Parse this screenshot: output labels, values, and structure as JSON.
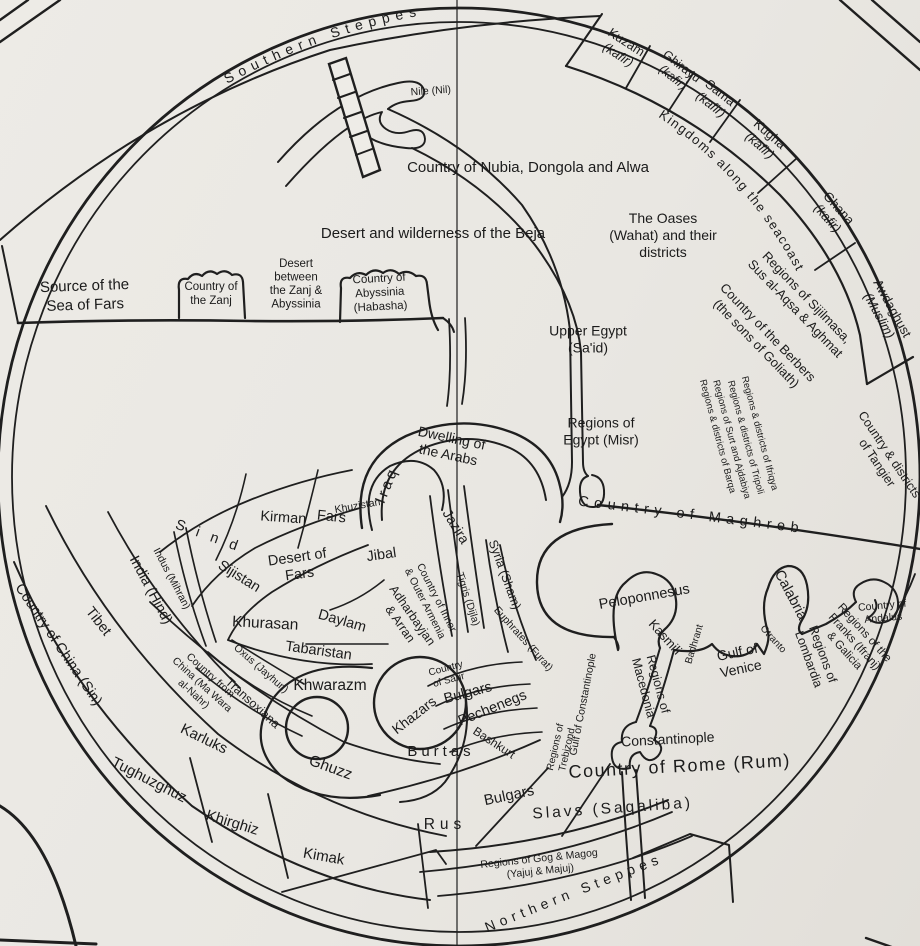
{
  "map": {
    "description": "Circular medieval world map (south at top) with translated region names",
    "colors": {
      "paper": "#eae8e3",
      "ink": "#1f1f1f",
      "fold_line": "#4a4a4a"
    },
    "arc_labels": [
      {
        "id": "southern-steppes",
        "text": "Southern Steppes",
        "path": "pathSouth",
        "size": 14,
        "ls": 6,
        "offset": "6%"
      },
      {
        "id": "kingdoms-seacoast",
        "text": "Kingdoms along the seacoast",
        "path": "pathSeacoast",
        "size": 13,
        "ls": 1.5,
        "offset": "2%"
      },
      {
        "id": "country-of-maghreb",
        "text": "Country of Maghreb",
        "path": "pathMaghreb",
        "size": 14.5,
        "ls": 5.5,
        "offset": "8%"
      },
      {
        "id": "northern-steppes",
        "text": "Northern Steppes",
        "path": "pathNorth",
        "size": 14,
        "ls": 5,
        "offset": "4%"
      }
    ],
    "labels": [
      {
        "id": "nile",
        "lines": [
          "Nile (Nil)"
        ],
        "x": 431,
        "y": 94,
        "rot": -4,
        "size": 10.5
      },
      {
        "id": "nubia-dongola-alwa",
        "lines": [
          "Country of Nubia, Dongola and Alwa"
        ],
        "x": 528,
        "y": 172,
        "rot": 0,
        "size": 15
      },
      {
        "id": "beja-desert",
        "lines": [
          "Desert and wilderness of the Beja"
        ],
        "x": 433,
        "y": 238,
        "rot": 0,
        "size": 15
      },
      {
        "id": "oases",
        "lines": [
          "The Oases",
          "(Wahat) and their",
          "districts"
        ],
        "x": 663,
        "y": 240,
        "rot": 0,
        "size": 14,
        "lh": 17
      },
      {
        "id": "source-sea-of-fars",
        "lines": [
          "Source of the",
          "Sea of Fars"
        ],
        "x": 85,
        "y": 300,
        "rot": -2,
        "size": 15,
        "lh": 19
      },
      {
        "id": "country-of-zanj",
        "lines": [
          "Country of",
          "the Zanj"
        ],
        "x": 211,
        "y": 297,
        "rot": 0,
        "size": 11.5,
        "lh": 14
      },
      {
        "id": "desert-zanj-abyssinia",
        "lines": [
          "Desert",
          "between",
          "the Zanj &",
          "Abyssinia"
        ],
        "x": 296,
        "y": 287,
        "rot": 0,
        "size": 11.5,
        "lh": 13.5
      },
      {
        "id": "abyssinia",
        "lines": [
          "Country of",
          "Abyssinia",
          "(Habasha)"
        ],
        "x": 380,
        "y": 296,
        "rot": -3,
        "size": 11.5,
        "lh": 14
      },
      {
        "id": "kuzam",
        "lines": [
          "Kuzam",
          "(kafir)"
        ],
        "x": 620,
        "y": 52,
        "rot": 33,
        "size": 13,
        "lh": 15,
        "i2": true
      },
      {
        "id": "ghirayu",
        "lines": [
          "Ghirayu",
          "(kafir)"
        ],
        "x": 675,
        "y": 75,
        "rot": 38,
        "size": 12.5,
        "lh": 14,
        "i2": true
      },
      {
        "id": "sama",
        "lines": [
          "Sama",
          "(kafir)"
        ],
        "x": 713,
        "y": 102,
        "rot": 38,
        "size": 13,
        "lh": 15,
        "i2": true
      },
      {
        "id": "kugha",
        "lines": [
          "Kugha",
          "(kafir)"
        ],
        "x": 762,
        "y": 143,
        "rot": 41,
        "size": 13,
        "lh": 15,
        "i2": true
      },
      {
        "id": "ghana",
        "lines": [
          "Ghana",
          "(kafir)"
        ],
        "x": 830,
        "y": 216,
        "rot": 48,
        "size": 13,
        "lh": 15,
        "i2": true
      },
      {
        "id": "awdaghust",
        "lines": [
          "Awdaghust",
          "(Muslim)"
        ],
        "x": 882,
        "y": 314,
        "rot": 61,
        "size": 13,
        "lh": 15,
        "i2": true
      },
      {
        "id": "sijilmasa",
        "lines": [
          "Regions of Sijilmasa,",
          "Sus al-Aqsa & Aghmat"
        ],
        "x": 798,
        "y": 306,
        "rot": 46,
        "size": 13,
        "lh": 16
      },
      {
        "id": "berbers",
        "lines": [
          "Country of the Berbers",
          "(the sons of Goliath)"
        ],
        "x": 759,
        "y": 341,
        "rot": 46,
        "size": 13,
        "lh": 16
      },
      {
        "id": "ifriqya",
        "lines": [
          "Regions & districts of Ifriqya"
        ],
        "x": 757,
        "y": 434,
        "rot": 75,
        "size": 9.5
      },
      {
        "id": "tripoli",
        "lines": [
          "Regions & districts of Tripoli"
        ],
        "x": 743,
        "y": 438,
        "rot": 75,
        "size": 9.5
      },
      {
        "id": "surt-ajdabiya",
        "lines": [
          "Regions of Surt and Ajdabiya"
        ],
        "x": 729,
        "y": 440,
        "rot": 75,
        "size": 9.5
      },
      {
        "id": "barqa",
        "lines": [
          "Regions & districts of Barqa"
        ],
        "x": 715,
        "y": 437,
        "rot": 75,
        "size": 9.5
      },
      {
        "id": "tangier",
        "lines": [
          "Country & districts",
          "of Tangier"
        ],
        "x": 880,
        "y": 461,
        "rot": 56,
        "size": 12.5,
        "lh": 15
      },
      {
        "id": "upper-egypt",
        "lines": [
          "Upper Egypt",
          "(Sa'id)"
        ],
        "x": 588,
        "y": 344,
        "rot": 0,
        "size": 14,
        "lh": 17
      },
      {
        "id": "regions-of-egypt",
        "lines": [
          "Regions of",
          "Egypt (Misr)"
        ],
        "x": 601,
        "y": 436,
        "rot": 0,
        "size": 14,
        "lh": 17
      },
      {
        "id": "dwelling-arabs",
        "lines": [
          "Dwelling of",
          "the Arabs"
        ],
        "x": 449,
        "y": 451,
        "rot": 12,
        "size": 14,
        "lh": 17
      },
      {
        "id": "iraq",
        "lines": [
          "Iraq"
        ],
        "x": 391,
        "y": 487,
        "rot": -68,
        "size": 15,
        "ls": 3
      },
      {
        "id": "khuzistan",
        "lines": [
          "Khuzistan"
        ],
        "x": 358,
        "y": 509,
        "rot": -10,
        "size": 10.5
      },
      {
        "id": "fars",
        "lines": [
          "Fars"
        ],
        "x": 331,
        "y": 521,
        "rot": 6,
        "size": 14.5
      },
      {
        "id": "kirman",
        "lines": [
          "Kirman"
        ],
        "x": 283,
        "y": 522,
        "rot": 4,
        "size": 14.5
      },
      {
        "id": "sind",
        "lines": [
          "S i n d"
        ],
        "x": 207,
        "y": 540,
        "rot": 20,
        "size": 14.5,
        "ls": 4
      },
      {
        "id": "sijistan",
        "lines": [
          "Sijistan"
        ],
        "x": 237,
        "y": 580,
        "rot": 32,
        "size": 14.5
      },
      {
        "id": "desert-of-fars",
        "lines": [
          "Desert of",
          "Fars"
        ],
        "x": 299,
        "y": 570,
        "rot": -8,
        "size": 14.5,
        "lh": 17
      },
      {
        "id": "jibal",
        "lines": [
          "Jibal"
        ],
        "x": 382,
        "y": 559,
        "rot": -8,
        "size": 14.5
      },
      {
        "id": "india",
        "lines": [
          "India (Hind)"
        ],
        "x": 147,
        "y": 592,
        "rot": 62,
        "size": 14.5
      },
      {
        "id": "indus",
        "lines": [
          "Indus (Mihran)"
        ],
        "x": 169,
        "y": 580,
        "rot": 62,
        "size": 10.5
      },
      {
        "id": "tibet",
        "lines": [
          "Tibet"
        ],
        "x": 95,
        "y": 624,
        "rot": 52,
        "size": 14.5
      },
      {
        "id": "china",
        "lines": [
          "Country of China (Sin)"
        ],
        "x": 55,
        "y": 647,
        "rot": 56,
        "size": 14.5
      },
      {
        "id": "khurasan",
        "lines": [
          "Khurasan"
        ],
        "x": 265,
        "y": 628,
        "rot": 3,
        "size": 15.5
      },
      {
        "id": "daylam",
        "lines": [
          "Daylam"
        ],
        "x": 341,
        "y": 625,
        "rot": 16,
        "size": 14.5
      },
      {
        "id": "tabaristan",
        "lines": [
          "Tabaristan"
        ],
        "x": 318,
        "y": 655,
        "rot": 8,
        "size": 14.5
      },
      {
        "id": "armenia",
        "lines": [
          "Country of Inner",
          "& Outer Armenia"
        ],
        "x": 428,
        "y": 602,
        "rot": 63,
        "size": 10.5,
        "lh": 13
      },
      {
        "id": "adharbayjan",
        "lines": [
          "Adharbayjan",
          "& Arran"
        ],
        "x": 403,
        "y": 622,
        "rot": 55,
        "size": 12.5,
        "lh": 15
      },
      {
        "id": "jazira",
        "lines": [
          "Jazira"
        ],
        "x": 452,
        "y": 529,
        "rot": 58,
        "size": 14
      },
      {
        "id": "tigris",
        "lines": [
          "Tigris (Dijla)"
        ],
        "x": 465,
        "y": 600,
        "rot": 72,
        "size": 10.5
      },
      {
        "id": "syria",
        "lines": [
          "Syria (Sham)"
        ],
        "x": 501,
        "y": 576,
        "rot": 70,
        "size": 12.5
      },
      {
        "id": "euphrates",
        "lines": [
          "Euphrates (Furat)"
        ],
        "x": 521,
        "y": 641,
        "rot": 48,
        "size": 10.5
      },
      {
        "id": "oxus",
        "lines": [
          "Oxus (Jayhun)"
        ],
        "x": 259,
        "y": 671,
        "rot": 41,
        "size": 10.5
      },
      {
        "id": "khwarazm",
        "lines": [
          "Khwarazm"
        ],
        "x": 330,
        "y": 690,
        "rot": 0,
        "size": 15.5
      },
      {
        "id": "country-from-china",
        "lines": [
          "Country from",
          "China (Ma Wara",
          "al-Nahr)"
        ],
        "x": 200,
        "y": 687,
        "rot": 42,
        "size": 10.5,
        "lh": 12.5
      },
      {
        "id": "transoxiana",
        "lines": [
          "Transoxiana"
        ],
        "x": 250,
        "y": 706,
        "rot": 42,
        "size": 12.5
      },
      {
        "id": "karluks",
        "lines": [
          "Karluks"
        ],
        "x": 202,
        "y": 743,
        "rot": 26,
        "size": 15
      },
      {
        "id": "tughuzghuz",
        "lines": [
          "Tughuzghuz"
        ],
        "x": 147,
        "y": 784,
        "rot": 27,
        "size": 15
      },
      {
        "id": "khirghiz",
        "lines": [
          "Khirghiz"
        ],
        "x": 231,
        "y": 827,
        "rot": 17,
        "size": 15
      },
      {
        "id": "kimak",
        "lines": [
          "Kimak"
        ],
        "x": 323,
        "y": 861,
        "rot": 10,
        "size": 15
      },
      {
        "id": "ghuzz",
        "lines": [
          "Ghuzz"
        ],
        "x": 329,
        "y": 772,
        "rot": 20,
        "size": 15.5
      },
      {
        "id": "khazars",
        "lines": [
          "Khazars"
        ],
        "x": 417,
        "y": 719,
        "rot": -38,
        "size": 14
      },
      {
        "id": "country-of-sarir",
        "lines": [
          "Country",
          "of Sarir"
        ],
        "x": 448,
        "y": 677,
        "rot": -15,
        "size": 10,
        "lh": 12
      },
      {
        "id": "bulgars-volga",
        "lines": [
          "Bulgars"
        ],
        "x": 469,
        "y": 697,
        "rot": -15,
        "size": 14.5
      },
      {
        "id": "pechenegs",
        "lines": [
          "Pechenegs"
        ],
        "x": 494,
        "y": 712,
        "rot": -22,
        "size": 14.5
      },
      {
        "id": "bashkurt",
        "lines": [
          "Bashkurt"
        ],
        "x": 492,
        "y": 746,
        "rot": 33,
        "size": 12
      },
      {
        "id": "burtas",
        "lines": [
          "Burtas"
        ],
        "x": 441,
        "y": 756,
        "rot": 0,
        "size": 15,
        "ls": 4
      },
      {
        "id": "bulgars-danube",
        "lines": [
          "Bulgars"
        ],
        "x": 510,
        "y": 800,
        "rot": -12,
        "size": 15
      },
      {
        "id": "rus",
        "lines": [
          "Rus"
        ],
        "x": 445,
        "y": 829,
        "rot": 0,
        "size": 15.5,
        "ls": 5
      },
      {
        "id": "slavs",
        "lines": [
          "Slavs (Saqaliba)"
        ],
        "x": 613,
        "y": 813,
        "rot": -4,
        "size": 15.5,
        "ls": 3
      },
      {
        "id": "gog-magog",
        "lines": [
          "Regions of Gog & Magog",
          "(Yajuj & Majuj)"
        ],
        "x": 540,
        "y": 868,
        "rot": -6,
        "size": 10.5,
        "lh": 12.5
      },
      {
        "id": "trebizond",
        "lines": [
          "Regions of",
          "Trebizond"
        ],
        "x": 564,
        "y": 749,
        "rot": -77,
        "size": 10,
        "lh": 12
      },
      {
        "id": "gulf-of-constantinople",
        "lines": [
          "Gulf of Constantinople"
        ],
        "x": 586,
        "y": 705,
        "rot": -79,
        "size": 10.5
      },
      {
        "id": "constantinople",
        "lines": [
          "Constantinople"
        ],
        "x": 668,
        "y": 744,
        "rot": -3,
        "size": 14
      },
      {
        "id": "country-of-rome",
        "lines": [
          "Country of Rome (Rum)"
        ],
        "x": 680,
        "y": 772,
        "rot": -3,
        "size": 18,
        "ls": 1.5
      },
      {
        "id": "peloponnesus",
        "lines": [
          "Peloponnesus"
        ],
        "x": 645,
        "y": 601,
        "rot": -10,
        "size": 14.5
      },
      {
        "id": "kasmili",
        "lines": [
          "Kasmili"
        ],
        "x": 662,
        "y": 640,
        "rot": 48,
        "size": 13
      },
      {
        "id": "badhrant",
        "lines": [
          "Badhrant"
        ],
        "x": 697,
        "y": 645,
        "rot": -73,
        "size": 10
      },
      {
        "id": "macedonia",
        "lines": [
          "Regions of",
          "Macedonia"
        ],
        "x": 647,
        "y": 687,
        "rot": 75,
        "size": 12.5,
        "lh": 15
      },
      {
        "id": "gulf-of-venice",
        "lines": [
          "Gulf of",
          "Venice"
        ],
        "x": 740,
        "y": 665,
        "rot": -12,
        "size": 14,
        "lh": 17
      },
      {
        "id": "otranto",
        "lines": [
          "Otranto"
        ],
        "x": 771,
        "y": 641,
        "rot": 48,
        "size": 10
      },
      {
        "id": "calabria",
        "lines": [
          "Calabria"
        ],
        "x": 787,
        "y": 597,
        "rot": 62,
        "size": 14.5
      },
      {
        "id": "lombardia",
        "lines": [
          "Regions of",
          "Lombardia"
        ],
        "x": 812,
        "y": 658,
        "rot": 70,
        "size": 12.5,
        "lh": 15
      },
      {
        "id": "franks-galicia",
        "lines": [
          "Regions of the",
          "Franks (Ifranj)",
          "& Galicia"
        ],
        "x": 852,
        "y": 644,
        "rot": 48,
        "size": 11.5,
        "lh": 13.5
      },
      {
        "id": "andalus",
        "lines": [
          "Country of",
          "Andalus"
        ],
        "x": 883,
        "y": 615,
        "rot": -5,
        "size": 10.5,
        "lh": 12.5
      }
    ]
  }
}
